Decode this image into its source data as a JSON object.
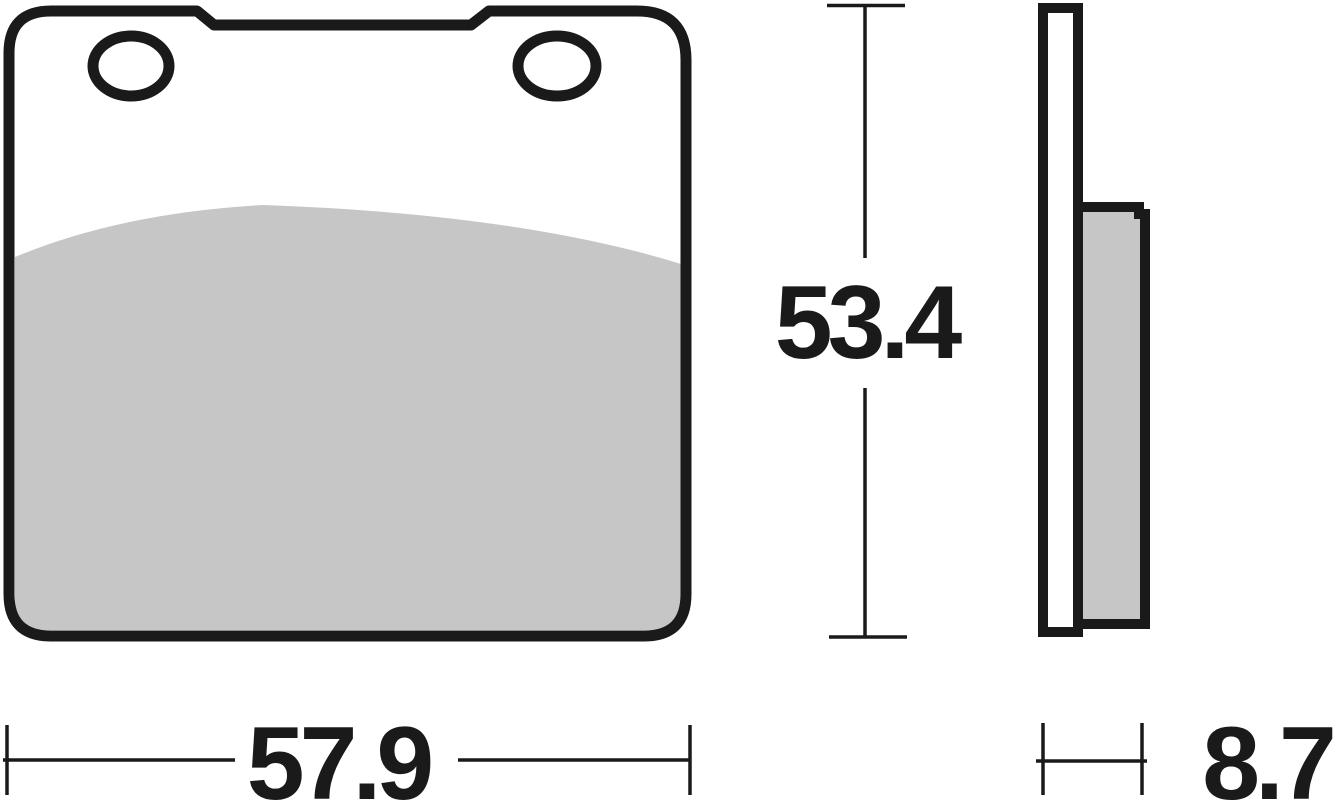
{
  "dimensions": {
    "height": "53.4",
    "width": "57.9",
    "thickness": "8.7"
  },
  "colors": {
    "ink": "#1a1a1a",
    "friction_material": "#c6c6c6",
    "background": "#ffffff"
  }
}
